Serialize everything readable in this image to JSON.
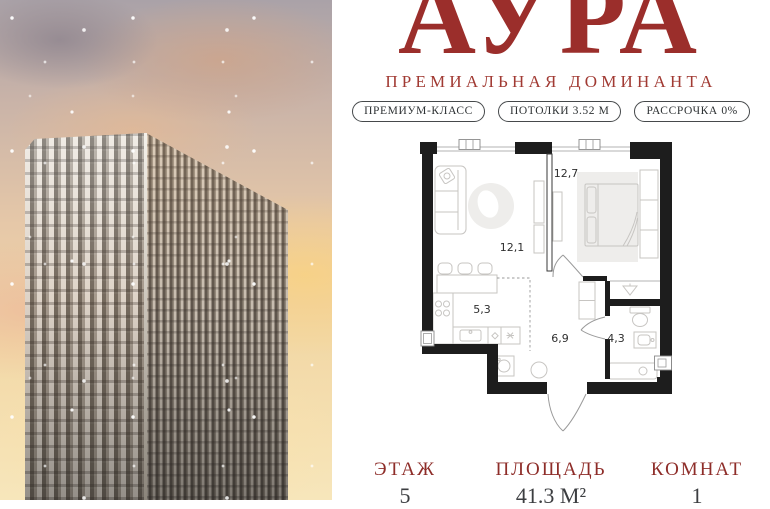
{
  "brand": {
    "title": "АУРА",
    "subtitle": "ПРЕМИАЛЬНАЯ ДОМИНАНТА"
  },
  "badges": [
    {
      "label": "ПРЕМИУМ-КЛАСС"
    },
    {
      "label": "ПОТОЛКИ 3.52 М"
    },
    {
      "label": "РАССРОЧКА 0%"
    }
  ],
  "plan": {
    "rooms": [
      {
        "name": "living-room",
        "area": "12,1"
      },
      {
        "name": "bedroom",
        "area": "12,7"
      },
      {
        "name": "kitchen",
        "area": "5,3"
      },
      {
        "name": "hallway",
        "area": "6,9"
      },
      {
        "name": "bathroom",
        "area": "4,3"
      }
    ]
  },
  "facts": [
    {
      "label": "ЭТАЖ",
      "value": "5"
    },
    {
      "label": "ПЛОЩАДЬ",
      "value": "41.3 М²"
    },
    {
      "label": "КОМНАТ",
      "value": "1"
    }
  ],
  "colors": {
    "accent_red": "#9b2e2b",
    "badge_outline": "#46494b",
    "plan_wall": "#1d1d1d",
    "text_dark": "#3c3e41"
  }
}
